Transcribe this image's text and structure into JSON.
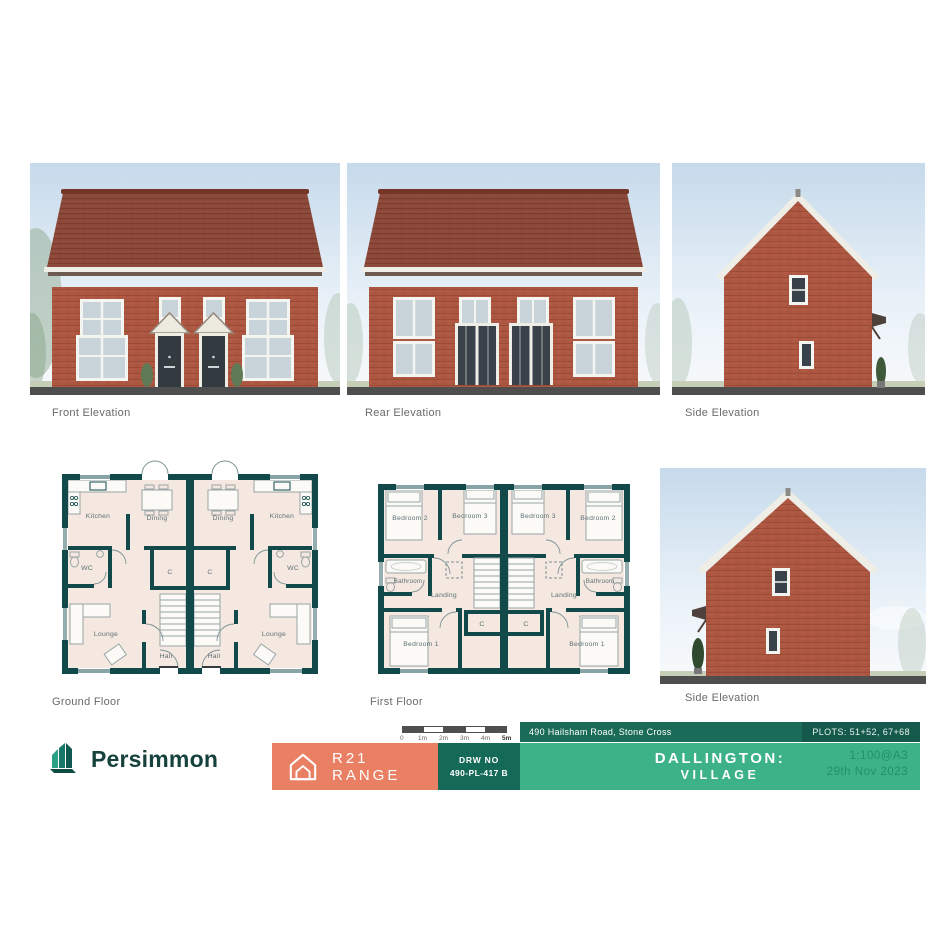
{
  "elevations": {
    "front": {
      "label": "Front Elevation"
    },
    "rear": {
      "label": "Rear Elevation"
    },
    "side_top": {
      "label": "Side Elevation"
    },
    "side_bottom": {
      "label": "Side Elevation"
    }
  },
  "plans": {
    "ground": {
      "label": "Ground Floor",
      "rooms": {
        "kitchen": "Kitchen",
        "dining": "Dining",
        "wc": "WC",
        "lounge": "Lounge",
        "hall": "Hall",
        "cupboard": "C"
      }
    },
    "first": {
      "label": "First Floor",
      "rooms": {
        "bedroom1": "Bedroom 1",
        "bedroom2": "Bedroom 2",
        "bedroom3": "Bedroom 3",
        "bathroom": "Bathroom",
        "landing": "Landing",
        "cupboard": "C"
      }
    }
  },
  "titleblock": {
    "brand": "Persimmon",
    "scale_ticks": [
      "0",
      "1m",
      "2m",
      "3m",
      "4m",
      "5m"
    ],
    "range_label": "R21 RANGE",
    "drw_no_label": "DRW NO",
    "drw_no_value": "490-PL-417 B",
    "address": "490 Hailsham Road, Stone Cross",
    "plots": "PLOTS: 51+52, 67+68",
    "development_line1": "DALLINGTON:",
    "development_line2": "VILLAGE",
    "scale": "1:100@A3",
    "date": "29th Nov 2023"
  },
  "icons": {
    "brand_logo": "persimmon-house-logo",
    "range_icon": "house-outline-icon"
  },
  "colors": {
    "accent_orange": "#E97F63",
    "teal_dark": "#156A57",
    "teal_strip": "#1B6B59",
    "green": "#3DB289",
    "plan_wall": "#124A4C",
    "plan_floor": "#F4E8E1",
    "brick": "#AE5742",
    "roof": "#8E4A3A"
  }
}
